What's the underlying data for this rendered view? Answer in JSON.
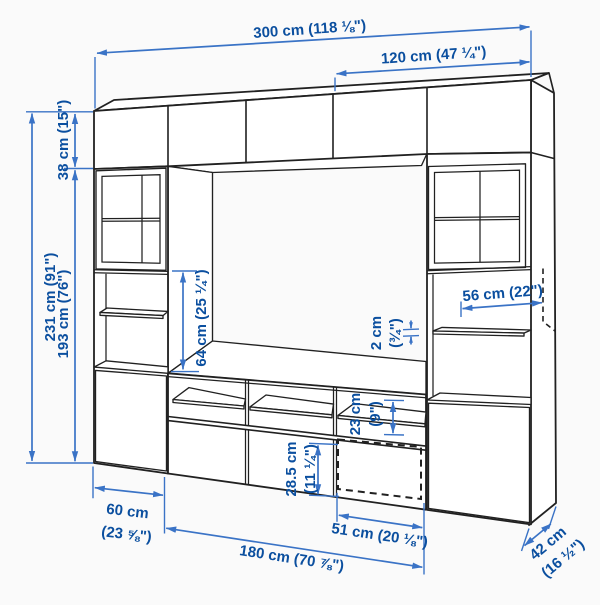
{
  "colors": {
    "outline": "#212121",
    "dimension_line": "#3a73c6",
    "dimension_text": "#0b4f9f",
    "background": "#fafafa",
    "surface": "#ffffff"
  },
  "dims": {
    "total_width": "300 cm (118 ⅛\")",
    "upper_right_width": "120 cm (47 ¼\")",
    "total_height": "231 cm (91\")",
    "top_cabinet_height": "38 cm (15\")",
    "lower_section_height": "193 cm (76\")",
    "open_section_height": "64 cm (25 ¼\")",
    "shelf_width": "56 cm (22\")",
    "shelf_thickness": [
      "2 cm",
      "(¾\")"
    ],
    "compartment_height": [
      "23 cm",
      "(9\")"
    ],
    "drawer_front_height": [
      "28.5 cm",
      "(11 ¼\")"
    ],
    "base_cabinet_width": [
      "60 cm",
      "(23 ⅝\")"
    ],
    "tv_bench_width": "180 cm (70 ⅞\")",
    "drawer_width": "51 cm (20 ⅛\")",
    "depth": [
      "42 cm",
      "(16 ½\")"
    ]
  }
}
